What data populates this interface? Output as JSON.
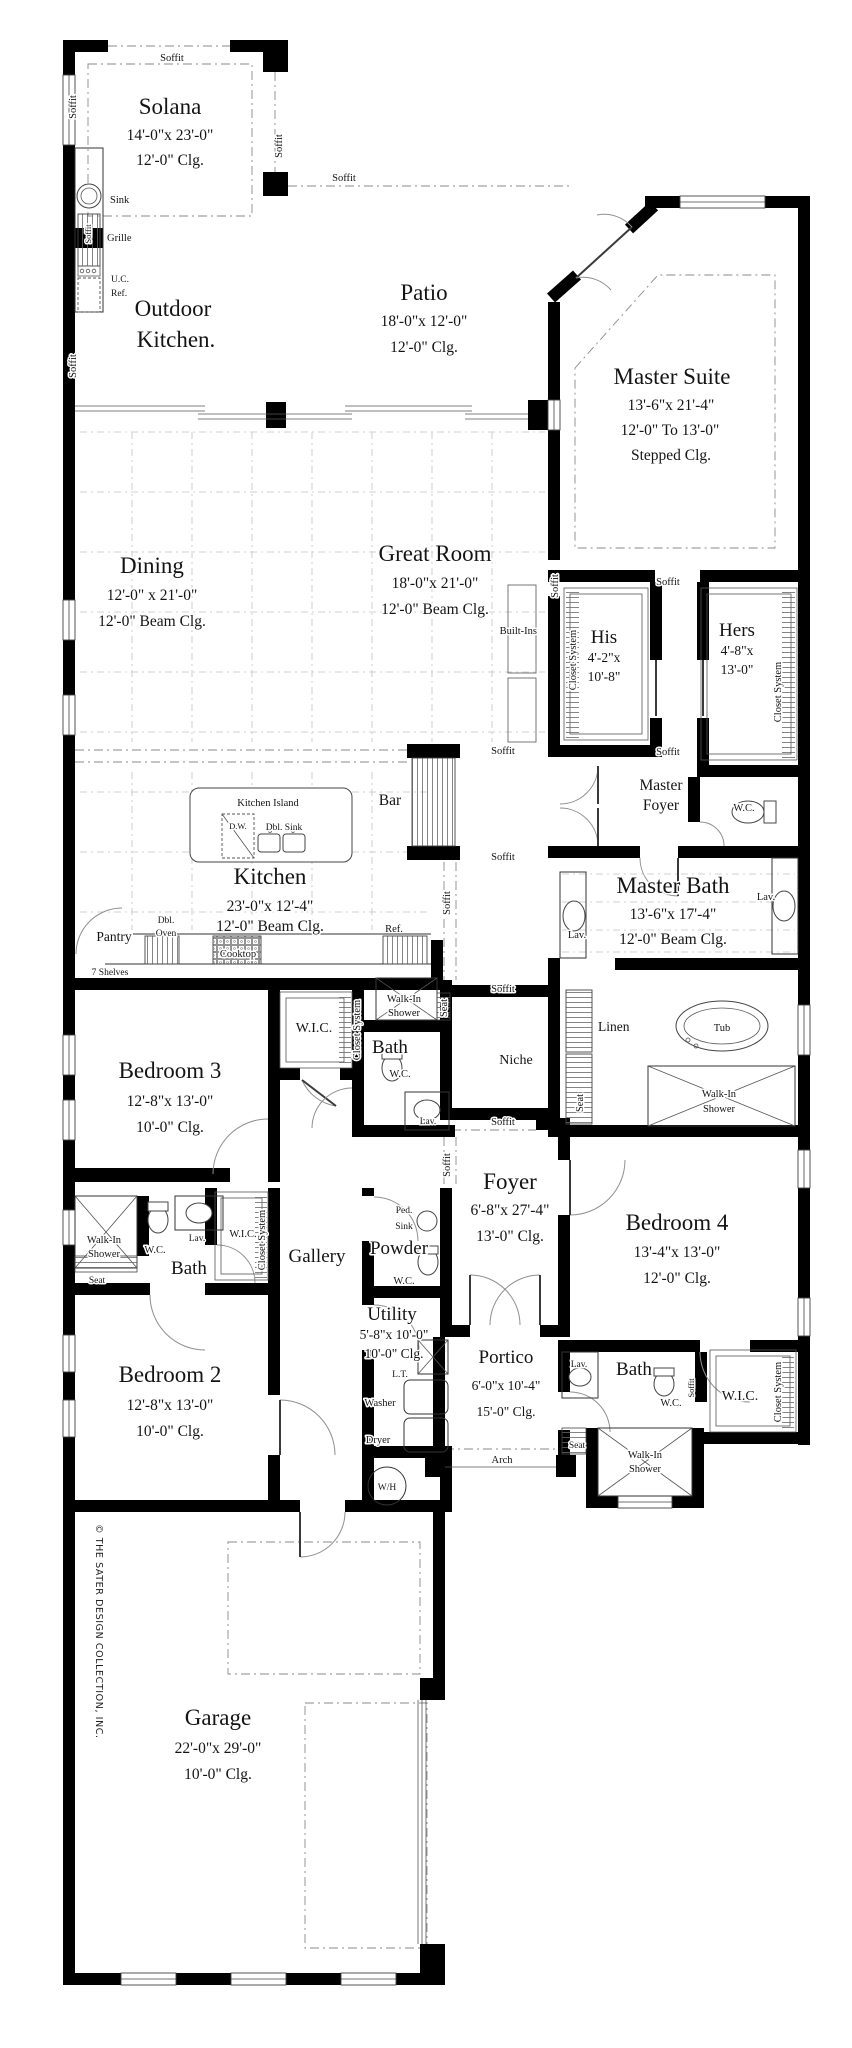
{
  "r": {
    "solana": {
      "name": "Solana",
      "dim": "14'-0\"x 23'-0\"",
      "clg": "12'-0\" Clg."
    },
    "outdoor_kitchen": {
      "line1": "Outdoor",
      "line2": "Kitchen."
    },
    "patio": {
      "name": "Patio",
      "dim": "18'-0\"x 12'-0\"",
      "clg": "12'-0\" Clg."
    },
    "master_suite": {
      "name": "Master Suite",
      "dim": "13'-6\"x 21'-4\"",
      "clg1": "12'-0\" To 13'-0\"",
      "clg2": "Stepped Clg."
    },
    "dining": {
      "name": "Dining",
      "dim": "12'-0\" x 21'-0\"",
      "clg": "12'-0\" Beam Clg."
    },
    "great_room": {
      "name": "Great Room",
      "dim": "18'-0\"x 21'-0\"",
      "clg": "12'-0\" Beam Clg."
    },
    "his": {
      "name": "His",
      "dim1": "4'-2\"x",
      "dim2": "10'-8\""
    },
    "hers": {
      "name": "Hers",
      "dim1": "4'-8\"x",
      "dim2": "13'-0\""
    },
    "kitchen": {
      "name": "Kitchen",
      "dim": "23'-0\"x 12'-4\"",
      "clg": "12'-0\" Beam Clg."
    },
    "master_bath": {
      "name": "Master Bath",
      "dim": "13'-6\"x 17'-4\"",
      "clg": "12'-0\" Beam Clg."
    },
    "bedroom3": {
      "name": "Bedroom 3",
      "dim": "12'-8\"x 13'-0\"",
      "clg": "10'-0\" Clg."
    },
    "foyer": {
      "name": "Foyer",
      "dim": "6'-8\"x 27'-4\"",
      "clg": "13'-0\" Clg."
    },
    "bedroom4": {
      "name": "Bedroom 4",
      "dim": "13'-4\"x 13'-0\"",
      "clg": "12'-0\" Clg."
    },
    "bedroom2": {
      "name": "Bedroom 2",
      "dim": "12'-8\"x 13'-0\"",
      "clg": "10'-0\" Clg."
    },
    "utility": {
      "name": "Utility",
      "dim": "5'-8\"x 10'-0\"",
      "clg": "10'-0\" Clg."
    },
    "portico": {
      "name": "Portico",
      "dim": "6'-0\"x 10'-4\"",
      "clg": "15'-0\" Clg."
    },
    "garage": {
      "name": "Garage",
      "dim": "22'-0\"x 29'-0\"",
      "clg": "10'-0\" Clg."
    },
    "master_foyer": {
      "line1": "Master",
      "line2": "Foyer"
    },
    "gallery": {
      "name": "Gallery"
    },
    "powder": {
      "name": "Powder"
    },
    "bath": {
      "name": "Bath"
    },
    "niche": {
      "name": "Niche"
    },
    "bar": {
      "name": "Bar"
    }
  },
  "c": {
    "soffit": "Soffit",
    "wc": "W.C.",
    "lav": "Lav.",
    "seat": "Seat",
    "walk_in": "Walk-In",
    "shower": "Shower",
    "closet_system": "Closet System",
    "wic": "W.I.C.",
    "linen": "Linen",
    "tub": "Tub",
    "arch": "Arch",
    "built_ins": "Built-Ins",
    "wh": "W/H"
  },
  "f": {
    "sink": "Sink",
    "grille": "Grille",
    "uc": "U.C.",
    "ref": "Ref.",
    "kitchen_island": "Kitchen Island",
    "dw": "D.W.",
    "dbl_sink": "Dbl. Sink",
    "dbl": "Dbl.",
    "oven": "Oven",
    "cooktop": "Cooktop",
    "pantry": "Pantry",
    "seven_shelves": "7 Shelves",
    "ped": "Ped.",
    "lt": "L.T.",
    "washer": "Washer",
    "dryer": "Dryer"
  },
  "copyright": "© THE SATER DESIGN COLLECTION, INC."
}
